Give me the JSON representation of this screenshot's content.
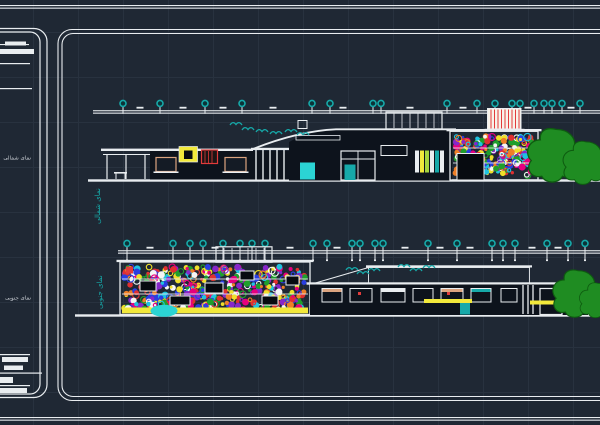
{
  "colors": {
    "bg": "#1f2834",
    "grid": "#28323f",
    "line": "#e9edf0",
    "teal": "#16a9a9",
    "bubble_fill": "#0b3237",
    "yellow": "#f2e93b",
    "red": "#e23b3b",
    "tan": "#dba37f",
    "cyan": "#2bd4d4",
    "darkfill": "#0d131c",
    "portal": "#070b10",
    "winfill": "#141b25",
    "tree": "#1f8c22",
    "treedark": "#0e5c10",
    "text": "#c9ced4",
    "lime": "#a6d53e"
  },
  "titleblock": {
    "north_label": "نمای شمالی",
    "south_label": "نمای جنوبی"
  },
  "palette_dots": [
    "#e6007e",
    "#e03030",
    "#2a3ee0",
    "#1f9e2c",
    "#efdf2a",
    "#1fc3e0",
    "#8727c9",
    "#ef7f27",
    "#f5f5f5"
  ],
  "elevations": {
    "north": {
      "side_label": "نمای شمالی",
      "dim": {
        "x0": 93,
        "x1": 600,
        "y": 110.2,
        "bubble_y": 103.4,
        "stem_to": 113.8,
        "tick_y": 106.8,
        "feet": false
      },
      "bubbles": [
        123,
        160,
        205,
        242,
        312,
        330,
        373,
        381,
        447,
        477,
        495,
        512,
        520,
        534,
        544,
        552,
        562,
        580
      ],
      "ticks": [
        140,
        183,
        223,
        273,
        343,
        410,
        463,
        528,
        571
      ],
      "birds": [
        [
          236,
          124
        ],
        [
          248,
          129
        ],
        [
          262,
          131
        ],
        [
          276,
          133
        ],
        [
          291,
          131
        ],
        [
          303,
          134
        ]
      ],
      "dot_panel": {
        "x": 453,
        "y": 134,
        "w": 83,
        "h": 44,
        "count": 240,
        "seed": 11
      },
      "bands": [
        147.5,
        162.5
      ],
      "cutouts": [
        [
          457,
          153.5,
          27,
          26.5
        ]
      ]
    },
    "south": {
      "side_label": "نمای جنوبی",
      "dim": {
        "x0": 118,
        "x1": 600,
        "y": 250.2,
        "bubble_y": 243.4,
        "stem_to": 259.5,
        "tick_y": 246.8,
        "feet": true
      },
      "bubbles": [
        127,
        173,
        190,
        203,
        223,
        240,
        252,
        265,
        313,
        327,
        352,
        360,
        375,
        383,
        428,
        457,
        492,
        503,
        515,
        547,
        568,
        585
      ],
      "ticks": [
        150,
        215,
        290,
        337,
        405,
        440,
        470,
        532,
        558
      ],
      "birds": [
        [
          352,
          269
        ],
        [
          363,
          273
        ],
        [
          374,
          270
        ],
        [
          404,
          266
        ],
        [
          416,
          270
        ],
        [
          429,
          267
        ]
      ],
      "dot_panel": {
        "x": 122,
        "y": 264,
        "w": 186,
        "h": 48.5,
        "count": 430,
        "seed": 23
      },
      "bands": [
        278.5,
        293.5
      ],
      "cutouts": [
        [
          140,
          281,
          16,
          10
        ],
        [
          170,
          296,
          20,
          9
        ],
        [
          205,
          283,
          18,
          10
        ],
        [
          240,
          271,
          14,
          9
        ],
        [
          262,
          296,
          16,
          9
        ],
        [
          286,
          276,
          13,
          9
        ]
      ]
    }
  }
}
